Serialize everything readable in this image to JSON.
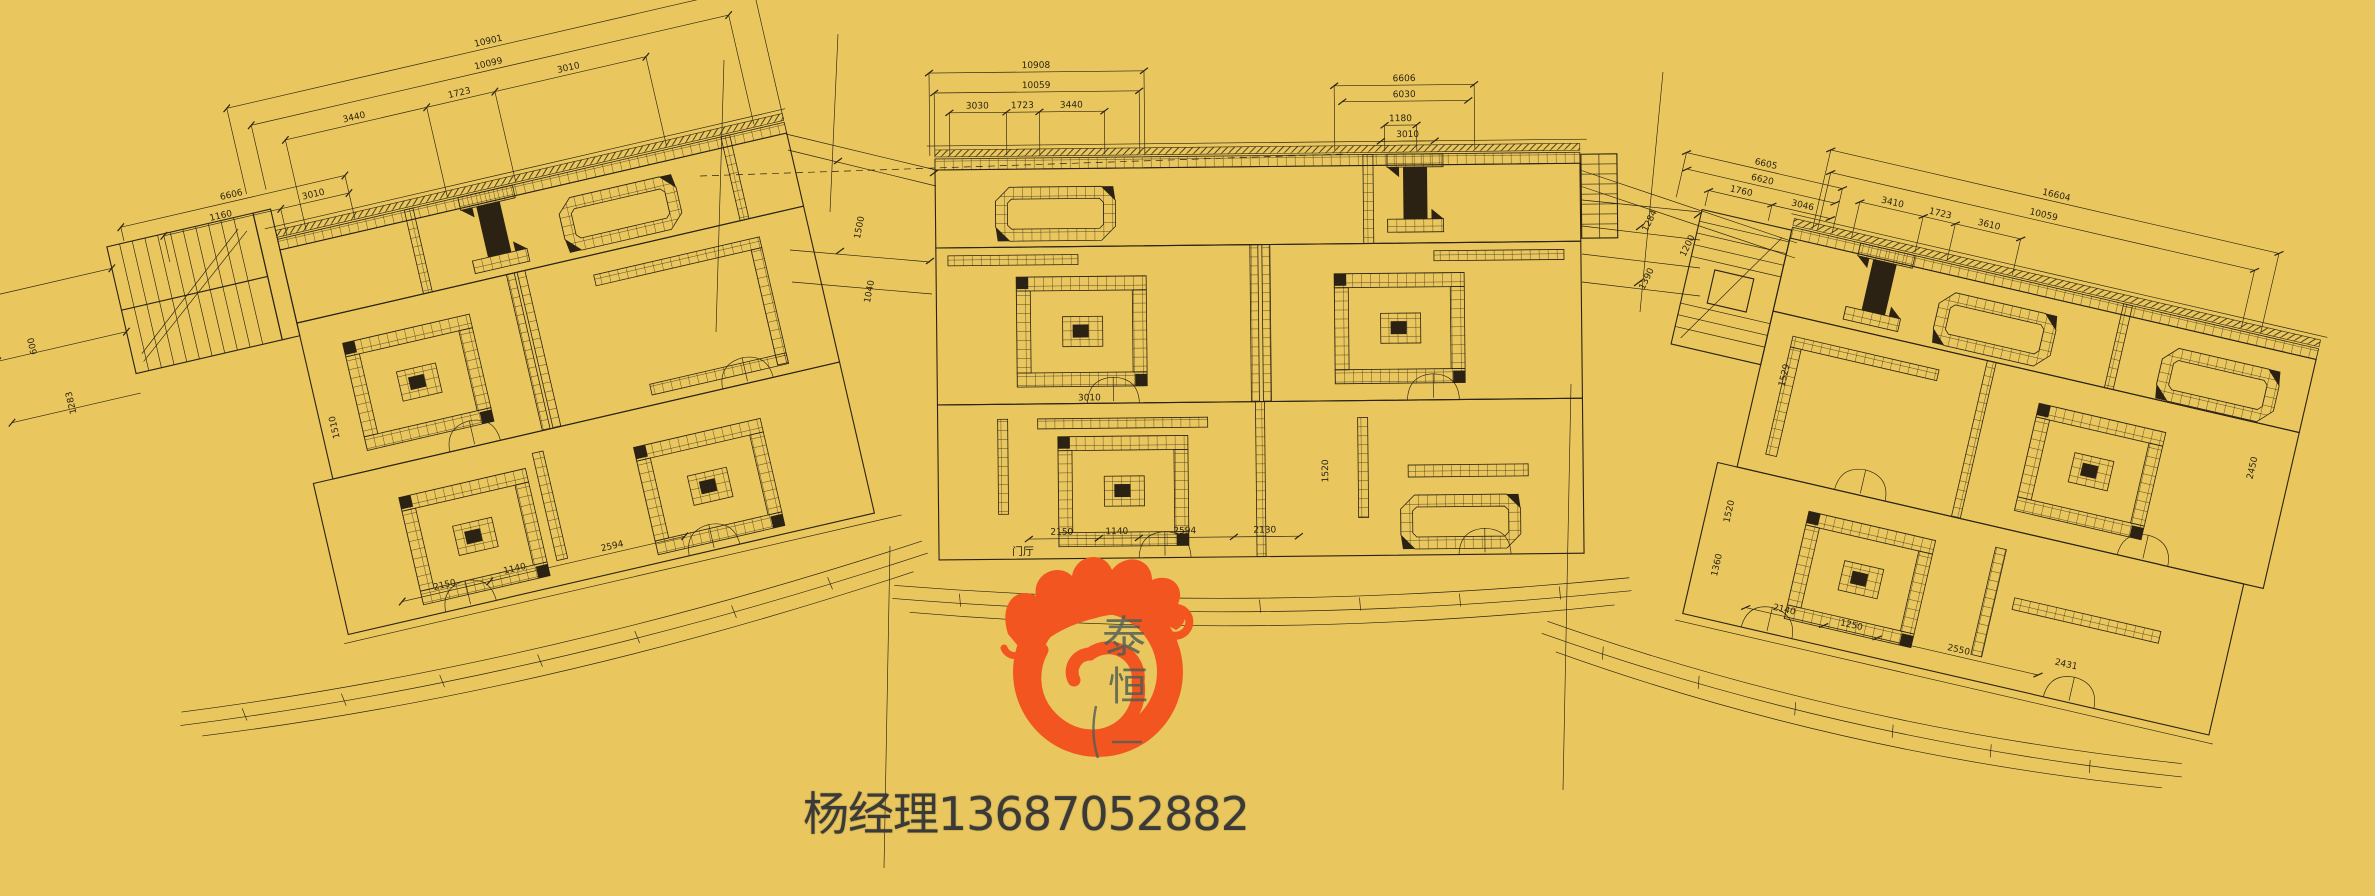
{
  "title": "curved-commercial-street-floor-plan",
  "colors": {
    "background": "#e9c75e",
    "ink": "#2b2213",
    "logo_orange": "#f2551f",
    "logo_character_color": "#4e5d55",
    "contact_text_color": "#3b3a36"
  },
  "watermark": {
    "contact": "杨经理13687052882",
    "logo_char_1": "泰",
    "logo_char_2": "恒"
  },
  "plans": {
    "left": {
      "chain": [
        "10901",
        "10099",
        "3440",
        "1723",
        "3010"
      ],
      "small": [
        "6606",
        "1160",
        "3010"
      ],
      "side": [
        "600",
        "1283"
      ],
      "inner": [
        "2150",
        "1140",
        "2594",
        "1510"
      ]
    },
    "center": {
      "chain": [
        "10908",
        "10059",
        "3030",
        "1723",
        "3440"
      ],
      "small": [
        "6606",
        "6030",
        "1180",
        "3010"
      ],
      "inner": [
        "2150",
        "1140",
        "2594",
        "2130",
        "3010",
        "1520"
      ],
      "room_label": "门厅"
    },
    "right": {
      "chain": [
        "16604",
        "10059",
        "3410",
        "1723",
        "3610"
      ],
      "small": [
        "6605",
        "6620",
        "1760",
        "3046"
      ],
      "side": [
        "1529",
        "2450",
        "1520",
        "1360"
      ],
      "inner": [
        "2140",
        "1250",
        "2550",
        "2431"
      ]
    },
    "gaps": {
      "left_center": [
        "1500",
        "1040"
      ],
      "center_right": [
        "1284",
        "1390",
        "1200"
      ]
    }
  }
}
